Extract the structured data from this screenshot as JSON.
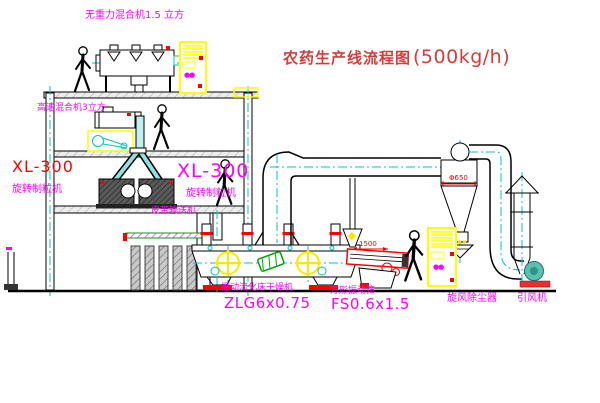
{
  "title": {
    "text": "农药生产线流程图",
    "capacity": "(500kg/h)"
  },
  "labels": {
    "top_mixer": "无重力混合机1.5 立方",
    "floor2_mixer": "高速混合机3立方",
    "xl_left_model": "XL-300",
    "xl_left_name": "旋转制粒机",
    "xl_center_model": "XL-300",
    "xl_center_name": "旋转制粒机",
    "conveyor": "皮带输送机",
    "dryer_name": "振动流化床干燥机",
    "dryer_model": "ZLG6x0.75",
    "sieve_name": "方形振动筛",
    "sieve_model": "FS0.6x1.5",
    "cyclone": "旋风除尘器",
    "fan": "引风机"
  },
  "dims": {
    "sieve": "1500",
    "cyclone": "Φ650"
  },
  "marks": {
    "cabinet": "●●"
  },
  "colors": {
    "magenta": "#ff00ff",
    "title_red": "#d43c3c",
    "red": "#ff0000",
    "yellow": "#ffff00",
    "centerline": "#00c4c4",
    "green": "#00a000",
    "fan_teal": "#5bc0b0",
    "line": "#000000"
  }
}
